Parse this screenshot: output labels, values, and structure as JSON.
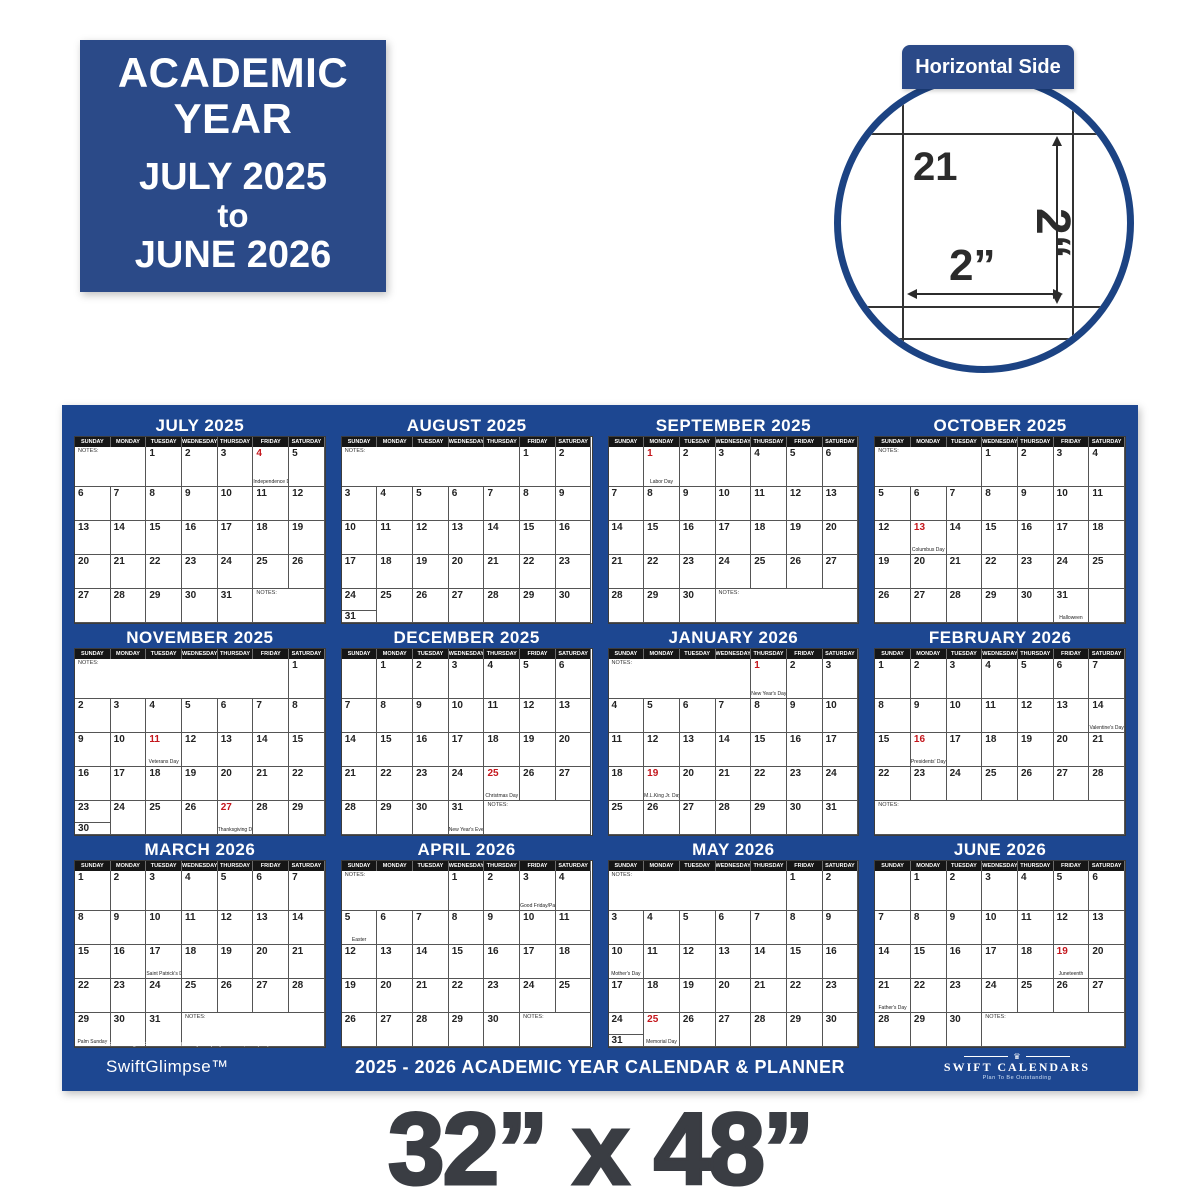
{
  "badge": {
    "line1": "ACADEMIC",
    "line2": "YEAR",
    "line3": "JULY 2025",
    "line4": "to",
    "line5": "JUNE 2026"
  },
  "inset": {
    "tab_label": "Horizontal Side",
    "cell_day": "21",
    "height_label": "2“",
    "width_label": "2”"
  },
  "calendar": {
    "day_headers": [
      "SUNDAY",
      "MONDAY",
      "TUESDAY",
      "WEDNESDAY",
      "THURSDAY",
      "FRIDAY",
      "SATURDAY"
    ],
    "notes_label": "NOTES:",
    "months": [
      {
        "name": "JULY 2025",
        "weeks": [
          [
            {
              "n": 1,
              "s": 2
            },
            1,
            2,
            3,
            {
              "d": 4,
              "r": 1,
              "h": "Independence Day"
            },
            5
          ],
          [
            6,
            7,
            8,
            9,
            10,
            11,
            12
          ],
          [
            13,
            14,
            15,
            16,
            17,
            18,
            19
          ],
          [
            20,
            21,
            22,
            23,
            24,
            25,
            26
          ],
          [
            27,
            28,
            29,
            30,
            31,
            {
              "n": 1,
              "s": 2
            }
          ]
        ]
      },
      {
        "name": "AUGUST 2025",
        "weeks": [
          [
            {
              "n": 1,
              "s": 5
            },
            1,
            2
          ],
          [
            3,
            4,
            5,
            6,
            7,
            8,
            9
          ],
          [
            10,
            11,
            12,
            13,
            14,
            15,
            16
          ],
          [
            17,
            18,
            19,
            20,
            21,
            22,
            23
          ],
          [
            {
              "d": 24,
              "o": 31
            },
            25,
            26,
            27,
            28,
            29,
            30
          ]
        ]
      },
      {
        "name": "SEPTEMBER 2025",
        "weeks": [
          [
            {
              "e": 1
            },
            {
              "d": 1,
              "r": 1,
              "h": "Labor Day"
            },
            2,
            3,
            4,
            5,
            6
          ],
          [
            7,
            8,
            9,
            10,
            11,
            12,
            13
          ],
          [
            14,
            15,
            16,
            17,
            18,
            19,
            20
          ],
          [
            21,
            22,
            23,
            24,
            25,
            26,
            27
          ],
          [
            28,
            29,
            30,
            {
              "n": 1,
              "s": 4
            }
          ]
        ]
      },
      {
        "name": "OCTOBER 2025",
        "weeks": [
          [
            {
              "n": 1,
              "s": 3
            },
            1,
            2,
            3,
            4
          ],
          [
            5,
            6,
            7,
            8,
            9,
            10,
            11
          ],
          [
            12,
            {
              "d": 13,
              "r": 1,
              "h": "Columbus Day"
            },
            14,
            15,
            16,
            17,
            18
          ],
          [
            19,
            20,
            21,
            22,
            23,
            24,
            25
          ],
          [
            26,
            27,
            28,
            29,
            30,
            {
              "d": 31,
              "h": "Halloween"
            },
            {
              "e": 1
            }
          ]
        ]
      },
      {
        "name": "NOVEMBER 2025",
        "weeks": [
          [
            {
              "n": 1,
              "s": 6
            },
            1
          ],
          [
            2,
            3,
            4,
            5,
            6,
            7,
            8
          ],
          [
            9,
            10,
            {
              "d": 11,
              "r": 1,
              "h": "Veterans Day"
            },
            12,
            13,
            14,
            15
          ],
          [
            16,
            17,
            18,
            19,
            20,
            21,
            22
          ],
          [
            {
              "d": 23,
              "o": 30
            },
            24,
            25,
            26,
            {
              "d": 27,
              "r": 1,
              "h": "Thanksgiving Day"
            },
            28,
            29
          ]
        ]
      },
      {
        "name": "DECEMBER 2025",
        "weeks": [
          [
            {
              "e": 1
            },
            1,
            2,
            3,
            4,
            5,
            6
          ],
          [
            7,
            8,
            9,
            10,
            11,
            12,
            13
          ],
          [
            14,
            15,
            16,
            17,
            18,
            19,
            20
          ],
          [
            21,
            22,
            23,
            24,
            {
              "d": 25,
              "r": 1,
              "h": "Christmas Day"
            },
            26,
            27
          ],
          [
            28,
            29,
            30,
            {
              "d": 31,
              "h": "New Year's Eve"
            },
            {
              "n": 1,
              "s": 3
            }
          ]
        ]
      },
      {
        "name": "JANUARY 2026",
        "weeks": [
          [
            {
              "n": 1,
              "s": 4
            },
            {
              "d": 1,
              "r": 1,
              "h": "New Year's Day"
            },
            2,
            3
          ],
          [
            4,
            5,
            6,
            7,
            8,
            9,
            10
          ],
          [
            11,
            12,
            13,
            14,
            15,
            16,
            17
          ],
          [
            18,
            {
              "d": 19,
              "r": 1,
              "h": "M.L.King Jr. Day"
            },
            20,
            21,
            22,
            23,
            24
          ],
          [
            25,
            26,
            27,
            28,
            29,
            30,
            31
          ]
        ]
      },
      {
        "name": "FEBRUARY 2026",
        "weeks": [
          [
            1,
            2,
            3,
            4,
            5,
            6,
            7
          ],
          [
            8,
            9,
            10,
            11,
            12,
            13,
            {
              "d": 14,
              "h": "Valentine's Day"
            }
          ],
          [
            15,
            {
              "d": 16,
              "r": 1,
              "h": "Presidents' Day"
            },
            17,
            18,
            19,
            20,
            21
          ],
          [
            22,
            23,
            24,
            25,
            26,
            27,
            28
          ],
          [
            {
              "n": 1,
              "s": 7
            }
          ]
        ]
      },
      {
        "name": "MARCH 2026",
        "weeks": [
          [
            1,
            2,
            3,
            4,
            5,
            6,
            7
          ],
          [
            8,
            9,
            10,
            11,
            12,
            13,
            14
          ],
          [
            15,
            16,
            {
              "d": 17,
              "h": "Saint Patrick's Day"
            },
            18,
            19,
            20,
            21
          ],
          [
            22,
            23,
            24,
            25,
            26,
            27,
            28
          ],
          [
            {
              "d": 29,
              "h": "Palm Sunday"
            },
            30,
            31,
            {
              "n": 1,
              "s": 4
            }
          ]
        ]
      },
      {
        "name": "APRIL 2026",
        "weeks": [
          [
            {
              "n": 1,
              "s": 3
            },
            1,
            2,
            {
              "d": 3,
              "h": "Good Friday/Passover"
            },
            4
          ],
          [
            {
              "d": 5,
              "h": "Easter"
            },
            6,
            7,
            8,
            9,
            10,
            11
          ],
          [
            12,
            13,
            14,
            15,
            16,
            17,
            18
          ],
          [
            19,
            20,
            21,
            22,
            23,
            24,
            25
          ],
          [
            26,
            27,
            28,
            29,
            30,
            {
              "n": 1,
              "s": 2
            }
          ]
        ]
      },
      {
        "name": "MAY 2026",
        "weeks": [
          [
            {
              "n": 1,
              "s": 5
            },
            1,
            2
          ],
          [
            3,
            4,
            5,
            6,
            7,
            8,
            9
          ],
          [
            {
              "d": 10,
              "h": "Mother's Day"
            },
            11,
            12,
            13,
            14,
            15,
            16
          ],
          [
            17,
            18,
            19,
            20,
            21,
            22,
            23
          ],
          [
            {
              "d": 24,
              "o": 31
            },
            {
              "d": 25,
              "r": 1,
              "h": "Memorial Day"
            },
            26,
            27,
            28,
            29,
            30
          ]
        ]
      },
      {
        "name": "JUNE 2026",
        "weeks": [
          [
            {
              "e": 1
            },
            1,
            2,
            3,
            4,
            5,
            6
          ],
          [
            7,
            8,
            9,
            10,
            11,
            12,
            13
          ],
          [
            14,
            15,
            16,
            17,
            18,
            {
              "d": 19,
              "r": 1,
              "h": "Juneteenth"
            },
            20
          ],
          [
            {
              "d": 21,
              "h": "Father's Day"
            },
            22,
            23,
            24,
            25,
            26,
            27
          ],
          [
            28,
            29,
            30,
            {
              "n": 1,
              "s": 4
            }
          ]
        ]
      }
    ]
  },
  "footer": {
    "brand_left": "SwiftGlimpse™",
    "copyright": "© 2024 All Rights Reserved - Reliable Way Company of Florida, LLC  (727) 330-7100",
    "title": "2025 - 2026 ACADEMIC YEAR CALENDAR & PLANNER",
    "item_number": "Item Number: SG 2025 ACA NAVY 54",
    "brand_right": "SWIFT CALENDARS",
    "tagline": "Plan To Be Outstanding"
  },
  "size_text": "32” x 48”",
  "colors": {
    "calendar_blue": "#1d4791",
    "badge_blue": "#2b4a88",
    "circle_navy": "#1c4383",
    "holiday_red": "#c4161c",
    "size_text_gray": "#3a3d43",
    "header_black": "#161616"
  }
}
